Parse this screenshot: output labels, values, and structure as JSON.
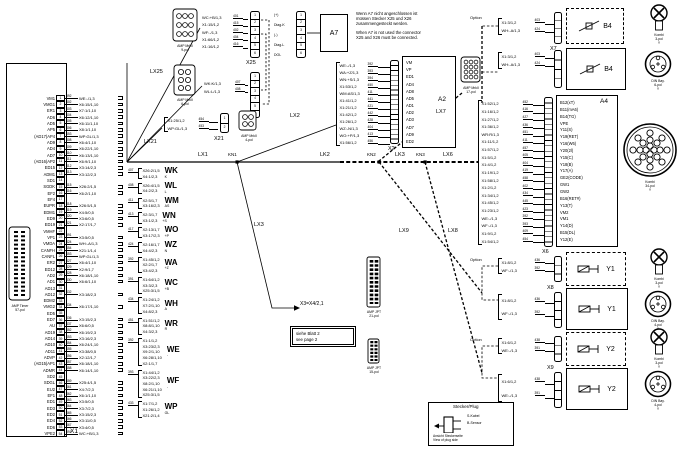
{
  "x1": {
    "label": "X1",
    "pins": [
      {
        "n": "VM1",
        "p": "1",
        "w": "392",
        "t": "WE:-/1,3"
      },
      {
        "n": "VMG1",
        "p": "2",
        "w": "402",
        "t": "X6:15/1,10"
      },
      {
        "n": "ER1",
        "p": "3",
        "w": "403",
        "t": "X7:1/1,10"
      },
      {
        "n": "AD6",
        "p": "4",
        "w": "404",
        "t": "X6:12/1,10"
      },
      {
        "n": "AD5",
        "p": "5",
        "w": "405",
        "t": "X6:11/1,10"
      },
      {
        "n": "AP5",
        "p": "6",
        "w": "406",
        "t": "X8:1/1,10"
      },
      {
        "n": "(AD17)AP4",
        "p": "7",
        "w": "453",
        "t": "WP:GL/1,3"
      },
      {
        "n": "AD9",
        "p": "8",
        "w": "408",
        "t": "X6:4/1,10"
      },
      {
        "n": "AD4",
        "p": "9",
        "w": "409",
        "t": "X6:22/1,10"
      },
      {
        "n": "AD7",
        "p": "10",
        "w": "410",
        "t": "X6:13/1,10"
      },
      {
        "n": "(AD16)AP2",
        "p": "11",
        "w": "411",
        "t": "X6:9/1,10"
      },
      {
        "n": "ED15",
        "p": "12",
        "w": "412",
        "t": "X3:14/2,3"
      },
      {
        "n": "ADM1",
        "p": "13",
        "w": "413",
        "t": "X3:12/2,3"
      },
      {
        "n": "SD1",
        "p": "14",
        "w": "",
        "t": ""
      },
      {
        "n": "SGDK",
        "p": "15",
        "w": "415",
        "t": "X26:2/1,5"
      },
      {
        "n": "EF2",
        "p": "16",
        "w": "416",
        "t": "X6:2/1,10"
      },
      {
        "n": "EF4",
        "p": "17",
        "w": "",
        "t": ""
      },
      {
        "n": "EUPR",
        "p": "18",
        "w": "418",
        "t": "X26:5/1,5"
      },
      {
        "n": "EDM1",
        "p": "19",
        "w": "419",
        "t": "X4:5/0,5"
      },
      {
        "n": "ED9",
        "p": "20",
        "w": "420",
        "t": "X3:6/0,5"
      },
      {
        "n": "ED19",
        "p": "21",
        "w": "421",
        "t": "X2:17/1,7"
      },
      {
        "n": "VMHF",
        "p": "22",
        "w": "",
        "t": ""
      },
      {
        "n": "VP1",
        "p": "23",
        "w": "391",
        "t": "X3:5/0,5"
      },
      {
        "n": "VMDA",
        "p": "24",
        "w": "424",
        "t": "WH:-A/1,3"
      },
      {
        "n": "CANFH",
        "p": "25",
        "w": "454",
        "t": "X21:1/1,4"
      },
      {
        "n": "CANFL",
        "p": "26",
        "w": "453",
        "t": "WP:GL/1,3"
      },
      {
        "n": "ER2",
        "p": "27",
        "w": "427",
        "t": "X6:4/1,10"
      },
      {
        "n": "ED12",
        "p": "28",
        "w": "429",
        "t": "X2:9/1,7"
      },
      {
        "n": "AD2",
        "p": "29",
        "w": "428",
        "t": "X6:18/1,10"
      },
      {
        "n": "AD1",
        "p": "30",
        "w": "430",
        "t": "X6:6/1,10"
      },
      {
        "n": "AD13",
        "p": "31",
        "w": "",
        "t": ""
      },
      {
        "n": "AD12",
        "p": "32",
        "w": "432",
        "t": "X3:18/2,3"
      },
      {
        "n": "EDM2",
        "p": "33",
        "w": "",
        "t": ""
      },
      {
        "n": "VMG2",
        "p": "34",
        "w": "434",
        "t": "X6:17/1,10"
      },
      {
        "n": "ED5",
        "p": "35",
        "w": "",
        "t": ""
      },
      {
        "n": "ED7",
        "p": "36",
        "w": "436",
        "t": "X3:15/2,3"
      },
      {
        "n": "AU",
        "p": "37",
        "w": "437",
        "t": "X6:6/0,5"
      },
      {
        "n": "AD19",
        "p": "38",
        "w": "452",
        "t": "X6:19/2,3"
      },
      {
        "n": "AD14",
        "p": "39",
        "w": "453",
        "t": "X3:16/2,3"
      },
      {
        "n": "AD10",
        "p": "40",
        "w": "454",
        "t": "X6:24/1,10"
      },
      {
        "n": "AD11",
        "p": "41",
        "w": "455",
        "t": "X3:38/0,5"
      },
      {
        "n": "ADVP",
        "p": "42",
        "w": "456",
        "t": "X2:12/1,7"
      },
      {
        "n": "(AD15)AP1",
        "p": "43",
        "w": "457",
        "t": "X6:18/1,10"
      },
      {
        "n": "ADMR",
        "p": "44",
        "w": "458",
        "t": "X6:14/1,10"
      },
      {
        "n": "SD2",
        "p": "45",
        "w": "",
        "t": ""
      },
      {
        "n": "SDGL",
        "p": "46",
        "w": "459",
        "t": "X25:4/1,5"
      },
      {
        "n": "EU2",
        "p": "47",
        "w": "461",
        "t": "X4:7/2,3"
      },
      {
        "n": "EF1",
        "p": "48",
        "w": "462",
        "t": "X6:1/1,10"
      },
      {
        "n": "ED1",
        "p": "49",
        "w": "463",
        "t": "X3:5/0,5"
      },
      {
        "n": "ED3",
        "p": "50",
        "w": "464",
        "t": "X3:7/2,3"
      },
      {
        "n": "ED2",
        "p": "51",
        "w": "465",
        "t": "X3:15/2,3"
      },
      {
        "n": "ED4",
        "p": "52",
        "w": "466",
        "t": "X3:11/0,5"
      },
      {
        "n": "ED6",
        "p": "53",
        "w": "467",
        "t": "X3:4/0,5"
      },
      {
        "n": "VPE2",
        "p": "54",
        "w": "391",
        "t": "WC:+B/1,3"
      }
    ]
  },
  "wire_groups": [
    {
      "num": "407",
      "label": "WK",
      "sub": "K",
      "items": [
        "X26:2/1,5",
        "X4:1/2,3"
      ]
    },
    {
      "num": "408",
      "label": "WL",
      "sub": "L",
      "items": [
        "X26:4/1,5",
        "X4:2/2,3"
      ]
    },
    {
      "num": "411",
      "label": "WM",
      "sub": "AS",
      "items": [
        "X2:5/1,7",
        "X3:16/2,3"
      ]
    },
    {
      "num": "413",
      "label": "WN",
      "sub": "+S",
      "items": [
        "X2:3/1,7",
        "X3:1/2,3"
      ]
    },
    {
      "num": "417",
      "label": "WO",
      "sub": "+P",
      "items": [
        "X2:13/1,7",
        "X3:17/2,3"
      ]
    },
    {
      "num": "424",
      "label": "WZ",
      "sub": "N",
      "items": [
        "X2:16/1,7",
        "X4:4/2,3"
      ]
    },
    {
      "num": "392",
      "label": "WA",
      "sub": "+Z",
      "items": [
        "X1:45/1,2",
        "X2:2/1,7",
        "X3:4/2,3"
      ]
    },
    {
      "num": "391",
      "label": "WC",
      "sub": "+B",
      "items": [
        "X1:64/1,2",
        "X3:3/2,3",
        "X25:3/1,5"
      ]
    },
    {
      "num": "434",
      "label": "WH",
      "sub": "A",
      "items": [
        "X1:24/1,2",
        "X7:2/1,10",
        "X4:8/2,3"
      ]
    },
    {
      "num": "451",
      "label": "WR",
      "sub": "R",
      "items": [
        "X1:51/1,2",
        "X8:8/1,10",
        "X4:3/2,3"
      ]
    },
    {
      "num": "392",
      "label": "WE",
      "sub": "-",
      "items": [
        "X1:1/1,2",
        "X3:23/2,3",
        "X9:2/1,10",
        "X6:28/1,10",
        "X2:1/1,7"
      ]
    },
    {
      "num": "393",
      "label": "WF",
      "sub": "-",
      "items": [
        "X1:44/1,2",
        "X3:22/2,3",
        "X8:2/1,10",
        "X6:21/1,10",
        "X25:3/1,5"
      ]
    },
    {
      "num": "433",
      "label": "WP",
      "sub": "GL",
      "items": [
        "X1:7/1,2",
        "X1:26/1,2",
        "X21:2/1,4"
      ]
    }
  ],
  "bus": {
    "lx1": "LX1",
    "kn1": "KN1",
    "lk2": "LK2",
    "kn2": "KN2",
    "lk3": "LK3",
    "kn3": "KN3",
    "lx6": "LX6",
    "lx2": "LX2",
    "lx3": "LX3",
    "lx7": "LX7",
    "lx8": "LX8",
    "lx9": "LX9",
    "lx25": "LX25",
    "lx21": "LX21",
    "x3x4": "X3=X4/2,1"
  },
  "pins6": [
    "1",
    "2",
    "3",
    "4",
    "5",
    "6"
  ],
  "pins2": [
    "1",
    "2"
  ],
  "top": {
    "x25_label": "X25",
    "x26_label": "X26",
    "a7_label": "A7",
    "x25_wires": [
      {
        "num": "401",
        "label": "WC:+B/1,3"
      },
      {
        "num": "415",
        "label": "X1:15/1,2"
      },
      {
        "num": "402",
        "label": "WF:-/1,3"
      },
      {
        "num": "404",
        "label": "X1:66/1,2"
      },
      {
        "num": "416",
        "label": "X1:16/1,2"
      }
    ],
    "x26_wires": [
      {
        "num": "407",
        "label": "WK:K/1,3"
      },
      {
        "num": "408",
        "label": "WL:L/1,3"
      }
    ],
    "diag": [
      "(+)",
      "Diag-K",
      "(-)",
      "Diag-L",
      "DOL"
    ],
    "note_de": [
      "Wenn A7 nicht angeschlossen ist",
      "müssen Stecker X25 und X26",
      "zusammengesteckt werden."
    ],
    "note_en": [
      "When A7 is not used the connector",
      "X25 and X26 must be connected."
    ]
  },
  "x21": {
    "label": "X21",
    "wires": [
      {
        "num": "454",
        "label": "X1:25/1,2"
      },
      {
        "num": "453",
        "label": "WP:GL/1,3"
      }
    ]
  },
  "a2": {
    "box": "A2",
    "conn": "X2",
    "wires": [
      {
        "num": "392",
        "label": "WE:-/1,3"
      },
      {
        "num": "393",
        "label": "WA:+Z/1,3"
      },
      {
        "num": "394",
        "label": "WN:+S/1,3"
      },
      {
        "num": "450",
        "label": "X1:53/1,2"
      },
      {
        "num": "411",
        "label": "WM:AS/1,3"
      },
      {
        "num": "441",
        "label": "X1:41/1,2"
      },
      {
        "num": "421",
        "label": "X1:21/1,2"
      },
      {
        "num": "442",
        "label": "X1:42/1,2"
      },
      {
        "num": "428",
        "label": "X1:26/1,2"
      },
      {
        "num": "404",
        "label": "WZ:-N/1,3"
      },
      {
        "num": "413",
        "label": "WO:+P/1,3"
      },
      {
        "num": "456",
        "label": "X1:56/1,2"
      }
    ],
    "pins": [
      "VM",
      "VP",
      "ED1",
      "AD4",
      "AD8",
      "AD5",
      "AD1",
      "AD2",
      "AD3",
      "AD7",
      "AD9",
      "ED2"
    ]
  },
  "a4": {
    "box": "A4",
    "conn": "X6",
    "wires": [
      {
        "num": "452",
        "label": "X1:52/1,2"
      },
      {
        "num": "416",
        "label": "X1:16/1,2"
      },
      {
        "num": "427",
        "label": "X1:27/1,2"
      },
      {
        "num": "436",
        "label": "X1:36/1,2"
      },
      {
        "num": "451",
        "label": "WR:R/1,3"
      },
      {
        "num": "411",
        "label": "X1:11/1,2"
      },
      {
        "num": "457",
        "label": "X1:57/1,2"
      },
      {
        "num": "405",
        "label": "X1:5/1,2"
      },
      {
        "num": "404",
        "label": "X1:4/1,2"
      },
      {
        "num": "419",
        "label": "X1:19/1,2"
      },
      {
        "num": "458",
        "label": "X1:58/1,2"
      },
      {
        "num": "402",
        "label": "X1:2/1,2"
      },
      {
        "num": "434",
        "label": "X1:34/1,2"
      },
      {
        "num": "445",
        "label": "X1:45/1,2"
      },
      {
        "num": "423",
        "label": "X1:23/1,2"
      },
      {
        "num": "392",
        "label": "WE:-/1,3"
      },
      {
        "num": "393",
        "label": "WF:-/1,3"
      },
      {
        "num": "409",
        "label": "X1:9/1,2"
      },
      {
        "num": "454",
        "label": "X1:54/1,2"
      }
    ],
    "pins": [
      "B12(xT)",
      "B11(mA6)",
      "B14(TG)",
      "VPE",
      "Y11(S)",
      "Y19(RET)",
      "Y16(W6)",
      "Y20(2l)",
      "Y15(C)",
      "Y18(B)",
      "Y17(A)",
      "GE2(CODE)",
      "GW1",
      "GW2",
      "B16(RET#)",
      "Y13(T)",
      "VM2",
      "VM1",
      "Y14(D)",
      "B15(DL)",
      "Y12(E)"
    ]
  },
  "right": {
    "option": "Option",
    "x7": "X7",
    "x8": "X8",
    "x9": "X9",
    "b4opt": {
      "device": "B4",
      "wires": [
        {
          "num": "403",
          "label": "X1:3/1,2"
        },
        {
          "num": "424",
          "label": "WH:-A/1,3"
        }
      ]
    },
    "b4": {
      "device": "B4",
      "wires": [
        {
          "num": "403",
          "label": "X1:3/1,2"
        },
        {
          "num": "424",
          "label": "WH:-A/1,3"
        }
      ]
    },
    "y1opt": {
      "device": "Y1",
      "wires": [
        {
          "num": "436",
          "label": "X1:8/1,2"
        },
        {
          "num": "392",
          "label": "WF:-/1,3"
        }
      ]
    },
    "y1": {
      "device": "Y1",
      "wires": [
        {
          "num": "436",
          "label": "X1:8/1,2"
        },
        {
          "num": "392",
          "label": "WF:-/1,3"
        }
      ]
    },
    "y2opt": {
      "device": "Y2",
      "wires": [
        {
          "num": "438",
          "label": "X1:6/1,2"
        },
        {
          "num": "391",
          "label": "WE:-/1,3"
        }
      ]
    },
    "y2": {
      "device": "Y2",
      "wires": [
        {
          "num": "438",
          "label": "X1:6/1,2"
        },
        {
          "num": "391",
          "label": "WE:-/1,3"
        }
      ]
    }
  },
  "picts": {
    "amp9": [
      "AMP MrkII",
      "9-pol"
    ],
    "amp6": [
      "AMP MrkII",
      "6-pol"
    ],
    "amp4": [
      "AMP MrkII",
      "4-pol"
    ],
    "amp17": [
      "AMP MrkII",
      "17-pol"
    ],
    "timer": [
      "AMP Timer",
      "57-pol"
    ],
    "jpt21": [
      "AMP JPT",
      "21-pol"
    ],
    "jpt15": [
      "AMP JPT",
      "15-pol"
    ],
    "kombi3": [
      "Kombi",
      "3-pol",
      "Y"
    ],
    "din6": [
      "DIN Bay.",
      "6-pol",
      "Y"
    ],
    "din4": [
      "DIN Bay.",
      "4-pol",
      "Y"
    ],
    "kombi34": [
      "Kombi",
      "34-pol",
      "Y"
    ]
  },
  "bottom": {
    "note": [
      "siehe Blatt 2",
      "see page 2"
    ]
  },
  "legend": {
    "title": "Stecker/Plug",
    "labels": [
      "S-Kabel",
      "B-Sensor"
    ],
    "caption": [
      "Ansicht Steckerseite",
      "View of plug side"
    ]
  }
}
